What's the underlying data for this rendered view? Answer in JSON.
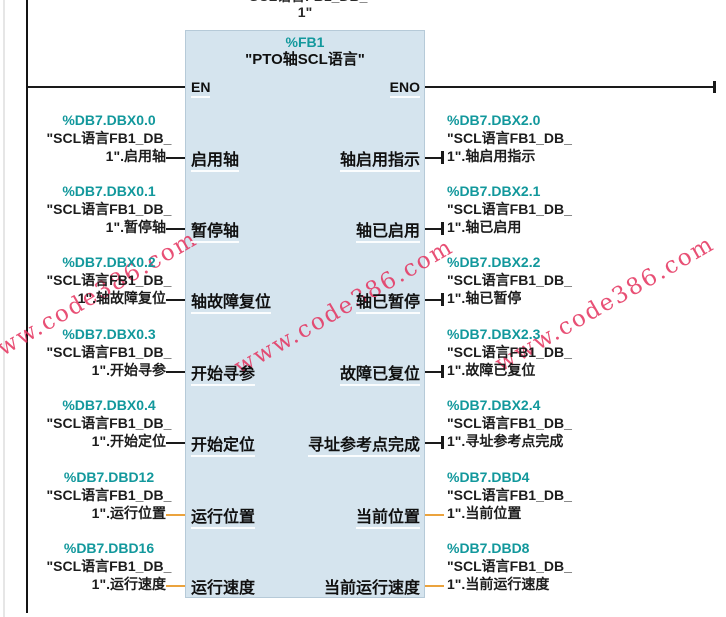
{
  "watermark": {
    "text": "www.code386.com"
  },
  "colors": {
    "block_fill": "#d5e4ee",
    "block_border": "#b6cad8",
    "address_teal": "#12989c",
    "bool_wire": "#1a1a1a",
    "real_wire": "#eba33d",
    "watermark": "#e5325e"
  },
  "network": {
    "instance_db_label_line1": "\"SCL语言FB1_DB_",
    "instance_db_label_line2": "1\"",
    "block": {
      "address": "%FB1",
      "title": "\"PTO轴SCL语言\"",
      "en": "EN",
      "eno": "ENO"
    },
    "inputs": [
      {
        "address": "%DB7.DBX0.0",
        "operand_line2": "\"SCL语言FB1_DB_",
        "operand_line3": "1\".启用轴",
        "pin": "启用轴",
        "type": "bool"
      },
      {
        "address": "%DB7.DBX0.1",
        "operand_line2": "\"SCL语言FB1_DB_",
        "operand_line3": "1\".暂停轴",
        "pin": "暂停轴",
        "type": "bool"
      },
      {
        "address": "%DB7.DBX0.2",
        "operand_line2": "\"SCL语言FB1_DB_",
        "operand_line3": "1\".轴故障复位",
        "pin": "轴故障复位",
        "type": "bool"
      },
      {
        "address": "%DB7.DBX0.3",
        "operand_line2": "\"SCL语言FB1_DB_",
        "operand_line3": "1\".开始寻参",
        "pin": "开始寻参",
        "type": "bool"
      },
      {
        "address": "%DB7.DBX0.4",
        "operand_line2": "\"SCL语言FB1_DB_",
        "operand_line3": "1\".开始定位",
        "pin": "开始定位",
        "type": "bool"
      },
      {
        "address": "%DB7.DBD12",
        "operand_line2": "\"SCL语言FB1_DB_",
        "operand_line3": "1\".运行位置",
        "pin": "运行位置",
        "type": "real"
      },
      {
        "address": "%DB7.DBD16",
        "operand_line2": "\"SCL语言FB1_DB_",
        "operand_line3": "1\".运行速度",
        "pin": "运行速度",
        "type": "real"
      }
    ],
    "outputs": [
      {
        "address": "%DB7.DBX2.0",
        "operand_line2": "\"SCL语言FB1_DB_",
        "operand_line3": "1\".轴启用指示",
        "pin": "轴启用指示",
        "type": "bool"
      },
      {
        "address": "%DB7.DBX2.1",
        "operand_line2": "\"SCL语言FB1_DB_",
        "operand_line3": "1\".轴已启用",
        "pin": "轴已启用",
        "type": "bool"
      },
      {
        "address": "%DB7.DBX2.2",
        "operand_line2": "\"SCL语言FB1_DB_",
        "operand_line3": "1\".轴已暂停",
        "pin": "轴已暂停",
        "type": "bool"
      },
      {
        "address": "%DB7.DBX2.3",
        "operand_line2": "\"SCL语言FB1_DB_",
        "operand_line3": "1\".故障已复位",
        "pin": "故障已复位",
        "type": "bool"
      },
      {
        "address": "%DB7.DBX2.4",
        "operand_line2": "\"SCL语言FB1_DB_",
        "operand_line3": "1\".寻址参考点完成",
        "pin": "寻址参考点完成",
        "type": "bool"
      },
      {
        "address": "%DB7.DBD4",
        "operand_line2": "\"SCL语言FB1_DB_",
        "operand_line3": "1\".当前位置",
        "pin": "当前位置",
        "type": "real"
      },
      {
        "address": "%DB7.DBD8",
        "operand_line2": "\"SCL语言FB1_DB_",
        "operand_line3": "1\".当前运行速度",
        "pin": "当前运行速度",
        "type": "real"
      }
    ]
  }
}
